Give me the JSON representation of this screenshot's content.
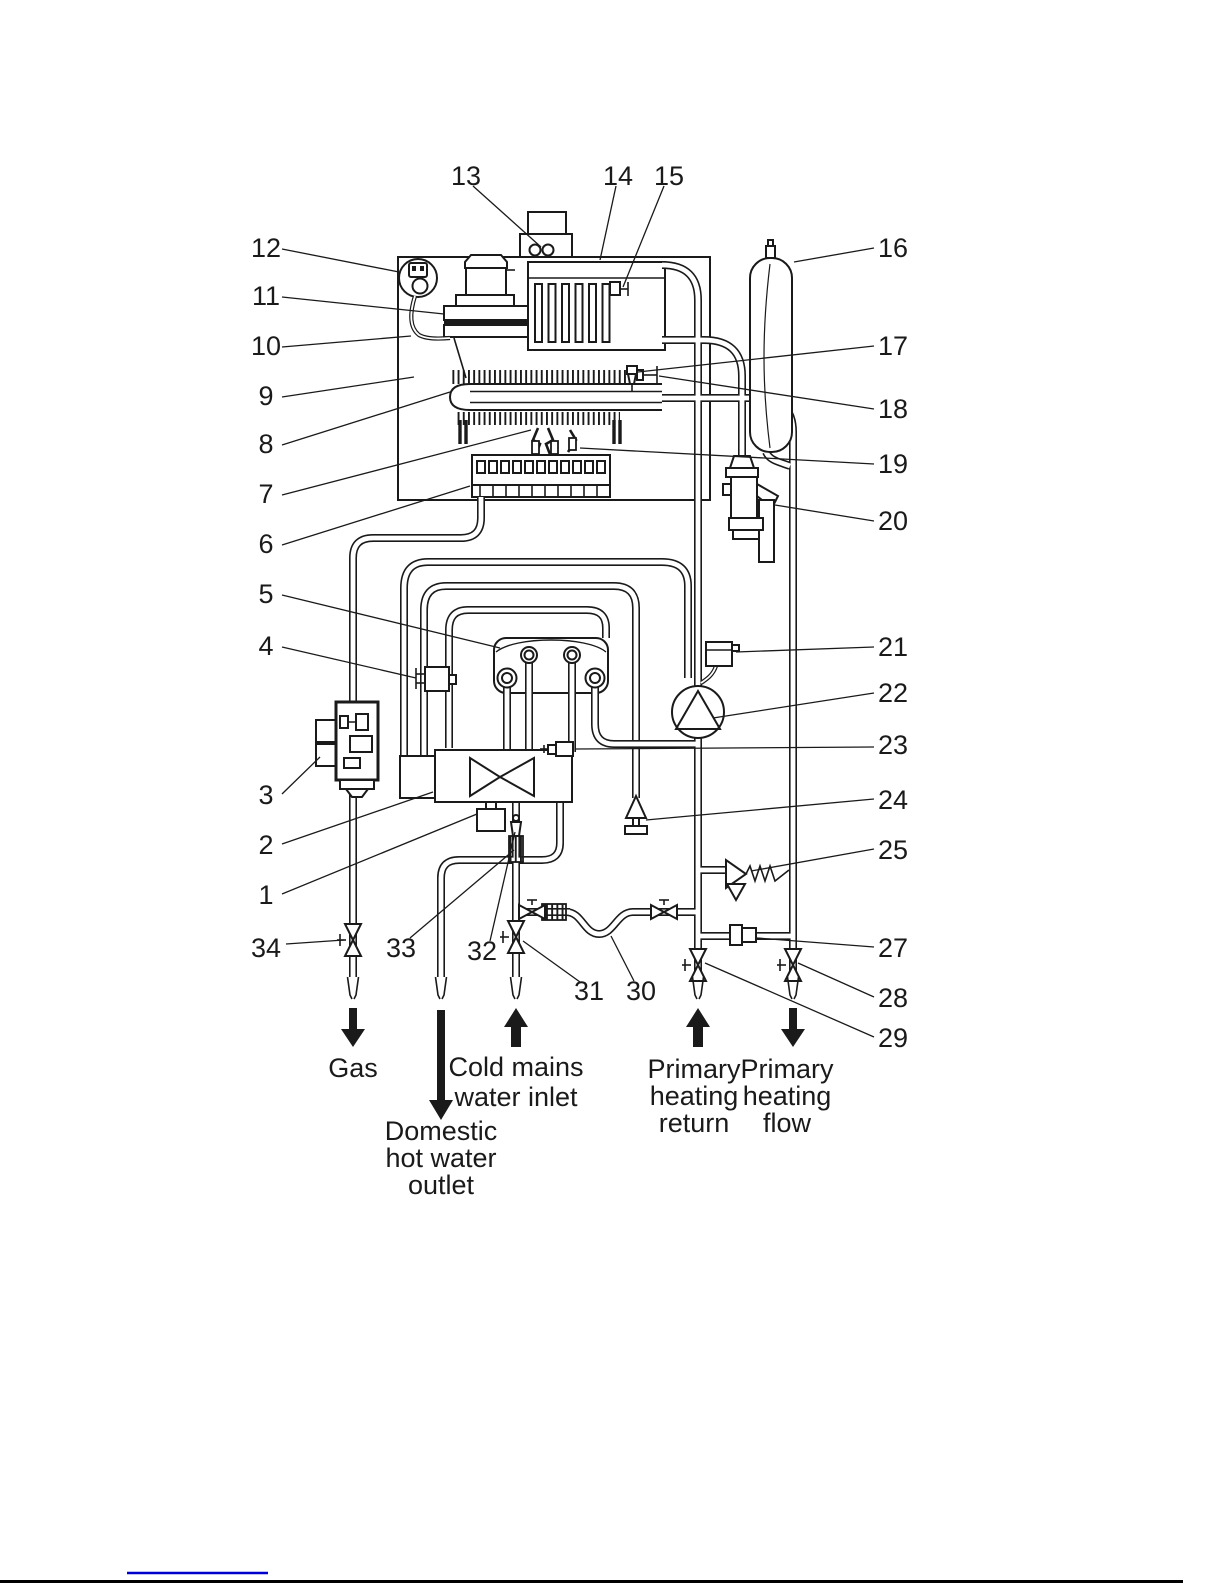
{
  "callouts": {
    "1": "1",
    "2": "2",
    "3": "3",
    "4": "4",
    "5": "5",
    "6": "6",
    "7": "7",
    "8": "8",
    "9": "9",
    "10": "10",
    "11": "11",
    "12": "12",
    "13": "13",
    "14": "14",
    "15": "15",
    "16": "16",
    "17": "17",
    "18": "18",
    "19": "19",
    "20": "20",
    "21": "21",
    "22": "22",
    "23": "23",
    "24": "24",
    "25": "25",
    "27": "27",
    "28": "28",
    "29": "29",
    "30": "30",
    "31": "31",
    "32": "32",
    "33": "33",
    "34": "34"
  },
  "connections": {
    "gas": "Gas",
    "cold": [
      "Cold mains",
      "water inlet"
    ],
    "dhw": [
      "Domestic",
      "hot water",
      "outlet"
    ],
    "heating_return": [
      "Primary",
      "heating",
      "return"
    ],
    "heating_flow": [
      "Primary",
      "heating",
      "flow"
    ]
  },
  "colors": {
    "ink": "#1a1a1a",
    "link_blue": "#0000cc"
  }
}
